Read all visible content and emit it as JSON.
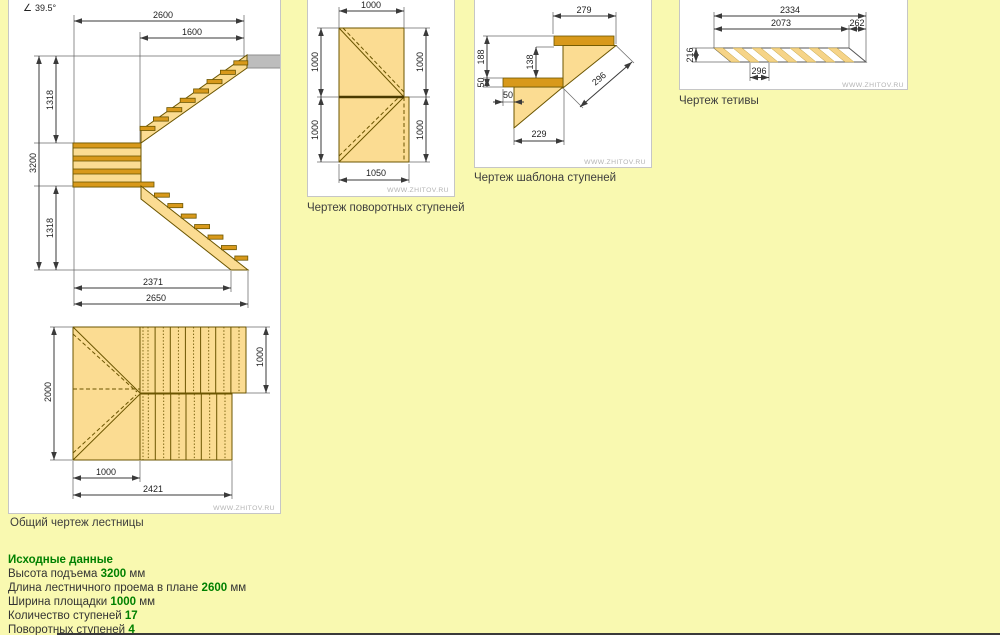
{
  "drawings": {
    "overall": {
      "caption": "Общий чертеж лестницы",
      "watermark": "WWW.ZHITOV.RU",
      "angle_symbol": "∠",
      "angle_value": "39.5°",
      "dims": {
        "opening_length": "2600",
        "upper_flight_run": "1600",
        "total_rise": "3200",
        "upper_rise": "1318",
        "lower_rise": "1318",
        "lower_flight_run": "2371",
        "total_run": "2650",
        "plan_depth": "2000",
        "flight_width": "1000",
        "landing_width": "1000",
        "plan_length": "2421"
      }
    },
    "turning_steps": {
      "caption": "Чертеж поворотных ступеней",
      "watermark": "WWW.ZHITOV.RU",
      "dims": {
        "top": "1000",
        "left_upper": "1000",
        "left_lower": "1000",
        "right_upper": "1000",
        "right_lower": "1000",
        "bottom": "1050"
      }
    },
    "step_template": {
      "caption": "Чертеж шаблона ступеней",
      "watermark": "WWW.ZHITOV.RU",
      "dims": {
        "tread_depth": "279",
        "rise_total": "188",
        "rise_clear": "138",
        "tread_thickness": "50",
        "nosing": "50",
        "slope": "296",
        "run": "229"
      }
    },
    "stringer": {
      "caption": "Чертеж тетивы",
      "watermark": "WWW.ZHITOV.RU",
      "dims": {
        "total_length": "2334",
        "cut_length": "2073",
        "end_offset": "262",
        "width": "216",
        "step_pitch": "296"
      }
    }
  },
  "source_data": {
    "heading": "Исходные данные",
    "rows": [
      {
        "label": "Высота подъема",
        "value": "3200",
        "unit": "мм"
      },
      {
        "label": "Длина лестничного проема в плане",
        "value": "2600",
        "unit": "мм"
      },
      {
        "label": "Ширина площадки",
        "value": "1000",
        "unit": "мм"
      },
      {
        "label": "Количество ступеней",
        "value": "17",
        "unit": ""
      },
      {
        "label": "Поворотных ступеней",
        "value": "4",
        "unit": ""
      }
    ]
  },
  "colors": {
    "page_bg": "#f9f9b0",
    "step_fill": "#fbdc92",
    "tread_fill": "#d8991b",
    "value_green": "#008000"
  }
}
